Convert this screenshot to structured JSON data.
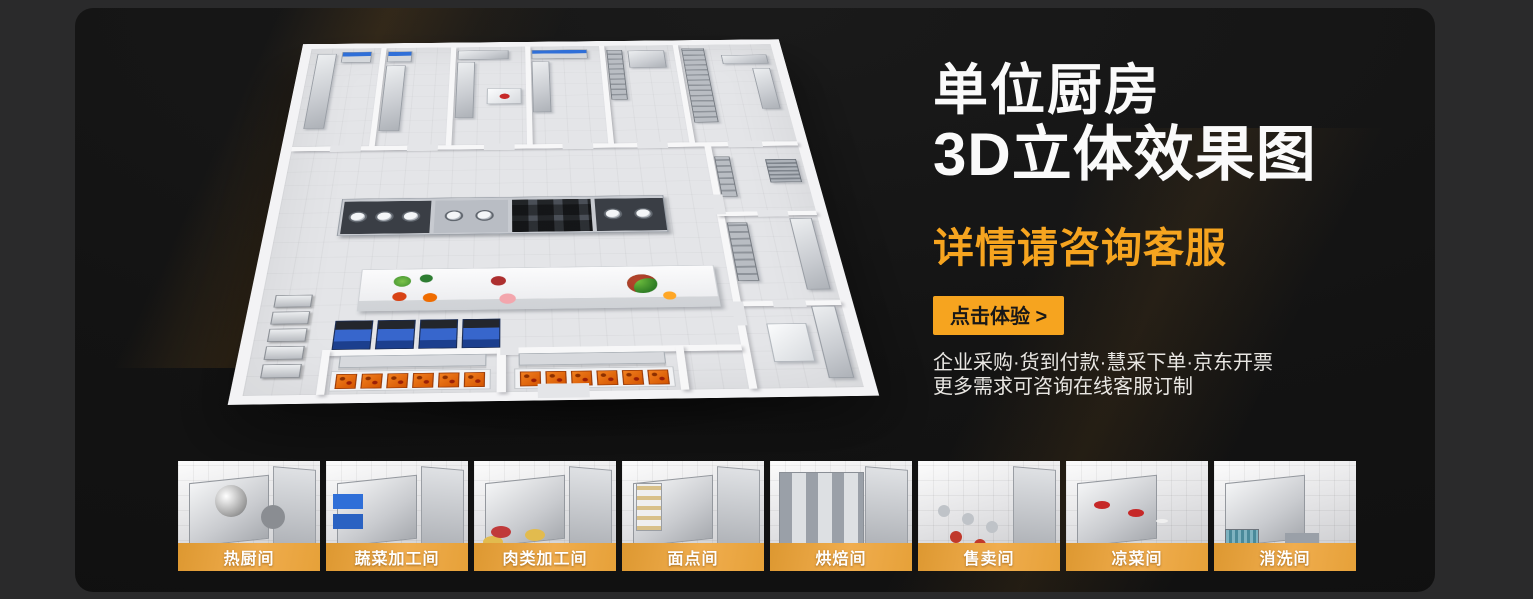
{
  "hero": {
    "title_line1": "单位厨房",
    "title_line2": "3D立体效果图",
    "subtitle": "详情请咨询客服",
    "cta_label": "点击体验 >",
    "info_line1": "企业采购·货到付款·慧采下单·京东开票",
    "info_line2": "更多需求可咨询在线客服订制",
    "accent_color": "#F6A41F",
    "cta_text_color": "#181818",
    "title_color": "#FAFAFA"
  },
  "floorplan": {
    "description": "3d-isometric-kitchen-floorplan",
    "wall_color": "#F5F5F7",
    "floor_color": "#E4E5E8"
  },
  "gallery": {
    "label_band_color": "#EFA23C",
    "items": [
      {
        "label": "热厨间"
      },
      {
        "label": "蔬菜加工间"
      },
      {
        "label": "肉类加工间"
      },
      {
        "label": "面点间"
      },
      {
        "label": "烘焙间"
      },
      {
        "label": "售卖间"
      },
      {
        "label": "凉菜间"
      },
      {
        "label": "消洗间"
      }
    ]
  }
}
